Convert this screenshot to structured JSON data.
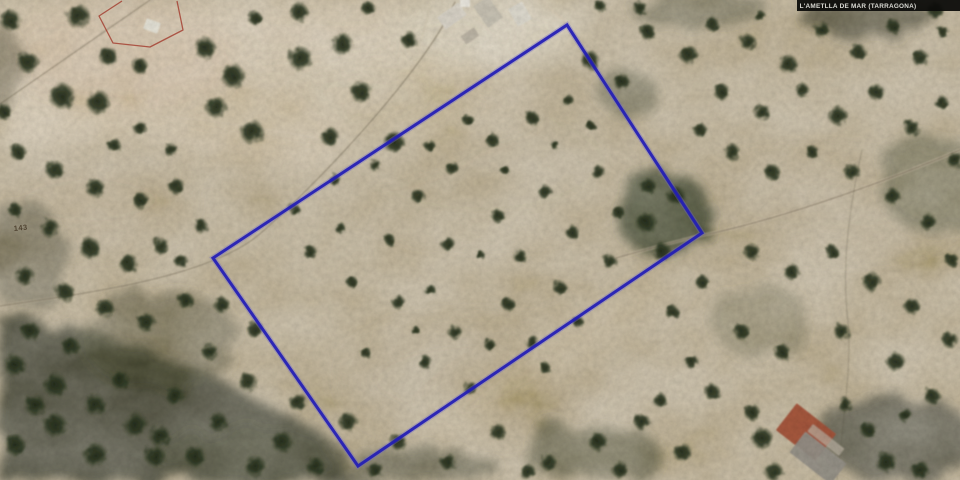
{
  "header": {
    "municipality_label": "L'AMETLLA DE MAR (TARRAGONA)"
  },
  "map": {
    "parcel_number": "143",
    "boundary_color": "#221db6",
    "boundary_points": "567,25 702,233 358,466 213,258",
    "reference_outline_color": "#a23a2c",
    "reference_outline_points": "122,1 99,16 113,43 150,47 183,30 177,1"
  },
  "scene": {
    "base_color": "#c0b197",
    "light_patches": [
      {
        "pts": "0,0 470,0 520,40 330,165 140,135 0,150",
        "fill": "#d9cab2",
        "op": 0.85
      },
      {
        "cx": 300,
        "cy": 120,
        "rx": 170,
        "ry": 55,
        "fill": "#cdbda4",
        "op": 0.6
      },
      {
        "cx": 490,
        "cy": 28,
        "rx": 95,
        "ry": 38,
        "fill": "#ded4bf",
        "op": 0.9
      },
      {
        "cx": 120,
        "cy": 55,
        "rx": 120,
        "ry": 55,
        "fill": "#d8c3ab",
        "op": 0.55
      },
      {
        "cx": 480,
        "cy": 160,
        "rx": 150,
        "ry": 75,
        "fill": "#bcac93",
        "op": 0.45
      },
      {
        "cx": 830,
        "cy": 205,
        "rx": 130,
        "ry": 45,
        "fill": "#c2b298",
        "op": 0.45
      },
      {
        "cx": 470,
        "cy": 380,
        "rx": 120,
        "ry": 55,
        "fill": "#b6a68c",
        "op": 0.45
      },
      {
        "cx": 90,
        "cy": 200,
        "rx": 95,
        "ry": 45,
        "fill": "#c0b096",
        "op": 0.5
      },
      {
        "cx": 545,
        "cy": 360,
        "rx": 160,
        "ry": 26,
        "rot": -33,
        "fill": "#c6b697",
        "op": 0.5
      },
      {
        "cx": 420,
        "cy": 90,
        "rx": 120,
        "ry": 45,
        "fill": "#d3c6ae",
        "op": 0.5
      }
    ],
    "dark_patches": [
      {
        "pts": "0,320 90,330 200,370 320,432 345,480 0,480",
        "fill": "#45453a",
        "op": 0.9
      },
      {
        "cx": 250,
        "cy": 455,
        "rx": 95,
        "ry": 28,
        "fill": "#4c4c3e",
        "op": 0.7
      },
      {
        "cx": 420,
        "cy": 468,
        "rx": 80,
        "ry": 20,
        "fill": "#50503f",
        "op": 0.6
      },
      {
        "cx": 665,
        "cy": 215,
        "rx": 48,
        "ry": 42,
        "fill": "#3c4230",
        "op": 0.8
      },
      {
        "cx": 625,
        "cy": 90,
        "rx": 30,
        "ry": 22,
        "fill": "#565844",
        "op": 0.55
      },
      {
        "cx": 935,
        "cy": 185,
        "rx": 55,
        "ry": 48,
        "fill": "#5c5c48",
        "op": 0.55
      },
      {
        "cx": 900,
        "cy": 440,
        "rx": 75,
        "ry": 45,
        "fill": "#44443a",
        "op": 0.7
      },
      {
        "cx": 25,
        "cy": 255,
        "rx": 40,
        "ry": 55,
        "fill": "#5a5848",
        "op": 0.55
      },
      {
        "cx": 160,
        "cy": 340,
        "rx": 80,
        "ry": 50,
        "fill": "#55543f",
        "op": 0.5
      },
      {
        "cx": 700,
        "cy": 10,
        "rx": 70,
        "ry": 18,
        "fill": "#50503e",
        "op": 0.5
      },
      {
        "cx": 590,
        "cy": 452,
        "rx": 70,
        "ry": 28,
        "fill": "#4e4e3c",
        "op": 0.6
      },
      {
        "cx": 870,
        "cy": 18,
        "rx": 70,
        "ry": 20,
        "fill": "#3e3e30",
        "op": 0.6
      },
      {
        "cx": 0,
        "cy": 70,
        "rx": 25,
        "ry": 45,
        "fill": "#55503c",
        "op": 0.5
      },
      {
        "cx": 760,
        "cy": 320,
        "rx": 50,
        "ry": 35,
        "fill": "#5f5d47",
        "op": 0.4
      }
    ],
    "tracks": [
      {
        "d": "M455,2 C430,62 330,172 262,232 C240,252 200,268 150,280 C100,292 40,300 0,306",
        "stroke": "#cfc2aa",
        "w": 3,
        "op": 0.35
      },
      {
        "d": "M455,2 C430,62 330,172 262,232 C240,252 200,268 150,280 C100,292 40,300 0,306",
        "stroke": "#5f5643",
        "w": 1,
        "op": 0.5
      },
      {
        "d": "M616,258 C666,244 690,238 704,235 C770,221 860,192 960,150",
        "stroke": "#d2c5ac",
        "w": 3.5,
        "op": 0.45
      },
      {
        "d": "M616,258 C666,244 690,238 704,235 C770,221 860,192 960,150",
        "stroke": "#6a5f4a",
        "w": 1,
        "op": 0.55
      },
      {
        "d": "M0,104 L150,0",
        "stroke": "#554c3a",
        "w": 1,
        "op": 0.45
      },
      {
        "d": "M540,0 C552,10 562,18 567,25",
        "stroke": "#d8cdb6",
        "w": 3,
        "op": 0.6
      },
      {
        "d": "M862,150 C850,205 841,262 848,322 C852,362 843,422 837,480",
        "stroke": "#5a523f",
        "w": 1,
        "op": 0.3
      },
      {
        "d": "M430,0 C428,18 424,34 416,52",
        "stroke": "#d8cdb6",
        "w": 2.5,
        "op": 0.5
      }
    ],
    "buildings": [
      {
        "x": 452,
        "y": 16,
        "w": 26,
        "h": 15,
        "r": -35,
        "fill": "#ddd8cc",
        "op": 0.95
      },
      {
        "x": 488,
        "y": 12,
        "w": 18,
        "h": 26,
        "r": -35,
        "fill": "#cac4b6",
        "op": 0.9
      },
      {
        "x": 520,
        "y": 14,
        "w": 16,
        "h": 20,
        "r": -30,
        "fill": "#e3dfd4",
        "op": 0.95
      },
      {
        "x": 470,
        "y": 36,
        "w": 16,
        "h": 10,
        "r": -35,
        "fill": "#b9b2a2",
        "op": 0.8
      },
      {
        "x": 152,
        "y": 26,
        "w": 15,
        "h": 11,
        "r": 20,
        "fill": "#eceade",
        "op": 0.95
      },
      {
        "x": 465,
        "y": 3,
        "w": 10,
        "h": 8,
        "r": 0,
        "fill": "#f2f0e8",
        "op": 0.9
      },
      {
        "x": 806,
        "y": 432,
        "w": 50,
        "h": 34,
        "r": 38,
        "fill": "#a8523a",
        "op": 0.95
      },
      {
        "x": 818,
        "y": 458,
        "w": 52,
        "h": 26,
        "r": 38,
        "fill": "#98938a",
        "op": 0.95
      },
      {
        "x": 826,
        "y": 440,
        "w": 40,
        "h": 9,
        "r": 38,
        "fill": "#c2b8a8",
        "op": 0.7
      }
    ],
    "trees": [
      [
        10,
        20,
        9
      ],
      [
        78,
        16,
        10
      ],
      [
        28,
        62,
        9
      ],
      [
        62,
        96,
        11
      ],
      [
        98,
        102,
        10
      ],
      [
        108,
        56,
        8
      ],
      [
        140,
        66,
        7
      ],
      [
        4,
        112,
        7
      ],
      [
        205,
        48,
        9
      ],
      [
        233,
        76,
        10
      ],
      [
        216,
        107,
        9
      ],
      [
        252,
        132,
        10
      ],
      [
        300,
        58,
        10
      ],
      [
        342,
        44,
        9
      ],
      [
        299,
        12,
        8
      ],
      [
        361,
        92,
        9
      ],
      [
        330,
        137,
        8
      ],
      [
        394,
        142,
        9
      ],
      [
        409,
        40,
        7
      ],
      [
        255,
        18,
        6
      ],
      [
        368,
        8,
        6
      ],
      [
        171,
        150,
        6
      ],
      [
        140,
        128,
        6
      ],
      [
        114,
        145,
        6
      ],
      [
        18,
        152,
        7
      ],
      [
        55,
        170,
        8
      ],
      [
        95,
        188,
        8
      ],
      [
        141,
        201,
        7
      ],
      [
        176,
        186,
        7
      ],
      [
        15,
        210,
        6
      ],
      [
        50,
        228,
        8
      ],
      [
        90,
        248,
        9
      ],
      [
        128,
        263,
        8
      ],
      [
        161,
        246,
        7
      ],
      [
        25,
        276,
        8
      ],
      [
        65,
        292,
        8
      ],
      [
        105,
        308,
        8
      ],
      [
        146,
        322,
        8
      ],
      [
        186,
        301,
        7
      ],
      [
        30,
        331,
        8
      ],
      [
        70,
        346,
        8
      ],
      [
        181,
        261,
        6
      ],
      [
        201,
        226,
        6
      ],
      [
        222,
        305,
        7
      ],
      [
        255,
        330,
        7
      ],
      [
        210,
        352,
        7
      ],
      [
        418,
        196,
        6
      ],
      [
        452,
        168,
        6
      ],
      [
        492,
        140,
        6
      ],
      [
        532,
        118,
        6
      ],
      [
        568,
        100,
        5
      ],
      [
        598,
        172,
        6
      ],
      [
        545,
        192,
        6
      ],
      [
        498,
        216,
        6
      ],
      [
        448,
        244,
        6
      ],
      [
        520,
        256,
        6
      ],
      [
        572,
        232,
        6
      ],
      [
        618,
        212,
        6
      ],
      [
        648,
        186,
        7
      ],
      [
        610,
        262,
        6
      ],
      [
        560,
        288,
        6
      ],
      [
        508,
        304,
        6
      ],
      [
        455,
        332,
        6
      ],
      [
        398,
        302,
        6
      ],
      [
        352,
        282,
        5
      ],
      [
        425,
        362,
        6
      ],
      [
        470,
        388,
        6
      ],
      [
        365,
        352,
        5
      ],
      [
        532,
        342,
        6
      ],
      [
        578,
        322,
        5
      ],
      [
        468,
        120,
        5
      ],
      [
        430,
        146,
        5
      ],
      [
        390,
        240,
        5
      ],
      [
        340,
        228,
        5
      ],
      [
        310,
        252,
        6
      ],
      [
        295,
        210,
        5
      ],
      [
        335,
        180,
        5
      ],
      [
        375,
        165,
        5
      ],
      [
        505,
        170,
        4
      ],
      [
        555,
        145,
        4
      ],
      [
        590,
        125,
        4
      ],
      [
        480,
        255,
        4
      ],
      [
        430,
        290,
        5
      ],
      [
        490,
        345,
        5
      ],
      [
        545,
        368,
        5
      ],
      [
        415,
        330,
        4
      ],
      [
        590,
        60,
        8
      ],
      [
        622,
        82,
        7
      ],
      [
        648,
        32,
        7
      ],
      [
        688,
        54,
        8
      ],
      [
        712,
        24,
        6
      ],
      [
        748,
        42,
        7
      ],
      [
        788,
        64,
        8
      ],
      [
        822,
        30,
        7
      ],
      [
        858,
        52,
        7
      ],
      [
        893,
        26,
        6
      ],
      [
        920,
        58,
        7
      ],
      [
        943,
        32,
        5
      ],
      [
        760,
        16,
        5
      ],
      [
        640,
        8,
        6
      ],
      [
        600,
        6,
        5
      ],
      [
        935,
        10,
        7
      ],
      [
        722,
        92,
        7
      ],
      [
        762,
        112,
        7
      ],
      [
        802,
        90,
        6
      ],
      [
        838,
        116,
        8
      ],
      [
        876,
        92,
        7
      ],
      [
        912,
        128,
        7
      ],
      [
        941,
        102,
        6
      ],
      [
        732,
        152,
        7
      ],
      [
        772,
        172,
        7
      ],
      [
        812,
        152,
        6
      ],
      [
        852,
        172,
        7
      ],
      [
        892,
        196,
        7
      ],
      [
        928,
        222,
        7
      ],
      [
        752,
        252,
        7
      ],
      [
        792,
        272,
        7
      ],
      [
        832,
        252,
        6
      ],
      [
        872,
        282,
        8
      ],
      [
        912,
        306,
        7
      ],
      [
        742,
        332,
        7
      ],
      [
        782,
        352,
        7
      ],
      [
        842,
        332,
        7
      ],
      [
        896,
        362,
        8
      ],
      [
        932,
        396,
        7
      ],
      [
        712,
        392,
        7
      ],
      [
        752,
        412,
        7
      ],
      [
        692,
        362,
        6
      ],
      [
        672,
        312,
        6
      ],
      [
        702,
        282,
        6
      ],
      [
        662,
        252,
        8
      ],
      [
        646,
        222,
        9
      ],
      [
        676,
        196,
        8
      ],
      [
        700,
        130,
        6
      ],
      [
        955,
        160,
        7
      ],
      [
        952,
        260,
        6
      ],
      [
        950,
        340,
        7
      ],
      [
        248,
        382,
        8
      ],
      [
        298,
        402,
        8
      ],
      [
        348,
        422,
        8
      ],
      [
        282,
        442,
        9
      ],
      [
        218,
        422,
        8
      ],
      [
        398,
        442,
        7
      ],
      [
        448,
        462,
        7
      ],
      [
        498,
        432,
        7
      ],
      [
        548,
        462,
        7
      ],
      [
        598,
        442,
        8
      ],
      [
        642,
        422,
        7
      ],
      [
        682,
        452,
        8
      ],
      [
        528,
        472,
        7
      ],
      [
        375,
        470,
        7
      ],
      [
        315,
        466,
        8
      ],
      [
        255,
        466,
        9
      ],
      [
        195,
        456,
        9
      ],
      [
        160,
        436,
        9
      ],
      [
        620,
        470,
        7
      ],
      [
        660,
        400,
        6
      ],
      [
        15,
        365,
        9
      ],
      [
        55,
        385,
        10
      ],
      [
        95,
        405,
        9
      ],
      [
        135,
        425,
        10
      ],
      [
        55,
        425,
        10
      ],
      [
        15,
        445,
        9
      ],
      [
        95,
        455,
        10
      ],
      [
        155,
        456,
        9
      ],
      [
        175,
        396,
        8
      ],
      [
        120,
        380,
        8
      ],
      [
        35,
        405,
        9
      ],
      [
        762,
        438,
        9
      ],
      [
        774,
        472,
        8
      ],
      [
        868,
        430,
        7
      ],
      [
        886,
        462,
        9
      ],
      [
        905,
        415,
        6
      ],
      [
        920,
        470,
        8
      ],
      [
        845,
        405,
        6
      ]
    ]
  }
}
